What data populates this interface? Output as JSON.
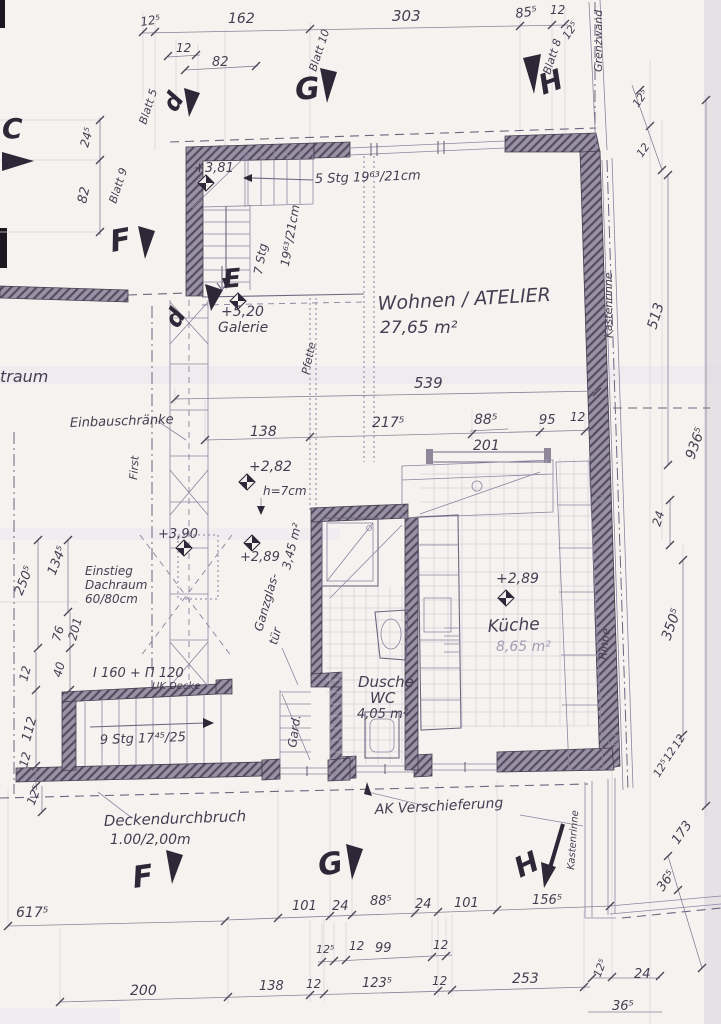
{
  "document": {
    "type": "scanned architectural floor plan, attic storey (Dachgeschoss)",
    "language": "German"
  },
  "colors": {
    "paper": "#f5f3ef",
    "ink": "#463d52",
    "pencil": "#8d84a0",
    "wall_hatch": "#8f8799",
    "scan_band": "#e8e5ee"
  },
  "markers": {
    "c": "C",
    "dtop": "d",
    "dmid": "d",
    "e": "E",
    "ftop": "F",
    "fbot": "F",
    "gtop": "G",
    "gbot": "G",
    "htop": "H",
    "hbot": "H"
  },
  "rooms": {
    "wohnen": "Wohnen / ATELIER",
    "wohnen_area": "27,65 m²",
    "kueche": "Küche",
    "kueche_area": "8,65 m²",
    "dusche": "Dusche",
    "wc": "WC",
    "dusche_area": "4,05 m²",
    "galerie": "Galerie",
    "flur_area": "3,45 m²",
    "gard": "Gard.",
    "partial": "traum"
  },
  "levels": {
    "l381": "+3,81",
    "l520": "+5,20",
    "l282": "+2,82",
    "h7": "h=7cm",
    "l390": "+3,90",
    "l289a": "+2,89",
    "l289b": "+2,89"
  },
  "stairs": {
    "s5": "5 Stg 19⁶³/21cm",
    "s7a": "7 Stg",
    "s7b": "19⁶³/21cm",
    "s9": "9 Stg 17⁴⁵/25"
  },
  "notes": {
    "einbau": "Einbauschränke",
    "einstieg1": "Einstieg",
    "einstieg2": "Dachraum",
    "einstieg3": "60/80cm",
    "beam1": "I 160 + Π 120",
    "beam2": "UK Decke",
    "decke1": "Deckendurchbruch",
    "decke2": "1.00/2,00m",
    "ak": "AK Verschieferung",
    "glas1": "Ganzglas-",
    "glas2": "tür",
    "first": "First",
    "pfette": "Pfette",
    "grenzwand": "Grenzwand",
    "kasten1": "Kastenrinne",
    "kasten2": "Kastenrinne",
    "rinne": "Rinne",
    "blatt5": "Blatt 5",
    "blatt8": "Blatt 8",
    "blatt9": "Blatt 9",
    "blatt10": "Blatt 10"
  },
  "dims": {
    "top": {
      "t125": "12⁵",
      "t162": "162",
      "t12a": "12",
      "t82": "82",
      "t303": "303",
      "t855": "85⁵",
      "t12b": "12",
      "t125b": "12⁵"
    },
    "left": {
      "l245": "24⁵",
      "l82": "82",
      "l2505": "250⁵",
      "l1345": "134⁵",
      "l76": "76",
      "l201": "201",
      "l40": "40",
      "l12a": "12",
      "l112": "112",
      "l12b": "12",
      "l125": "12⁵"
    },
    "mid": {
      "m539": "539",
      "m138": "138",
      "m2175": "217⁵",
      "m885": "88⁵",
      "m201": "201",
      "m95": "95",
      "m12": "12"
    },
    "right": {
      "r125a": "12⁵",
      "r12a": "12",
      "r513": "513",
      "r9365": "936⁵",
      "r24": "24",
      "r3505": "350⁵",
      "r125b": "12⁵",
      "r12b": "12",
      "r12c": "12",
      "r173": "173",
      "r365a": "36⁵",
      "r125c": "12⁵",
      "r24b": "24",
      "r365b": "36⁵"
    },
    "bottom": {
      "b6175": "617⁵",
      "b200": "200",
      "b101a": "101",
      "b24a": "24",
      "b885": "88⁵",
      "b24b": "24",
      "b101b": "101",
      "b1565": "156⁵",
      "b125": "12⁵",
      "b12a": "12",
      "b99": "99",
      "b12b": "12",
      "b138": "138",
      "b12c": "12",
      "b1235": "123⁵",
      "b12d": "12",
      "b253": "253"
    }
  }
}
